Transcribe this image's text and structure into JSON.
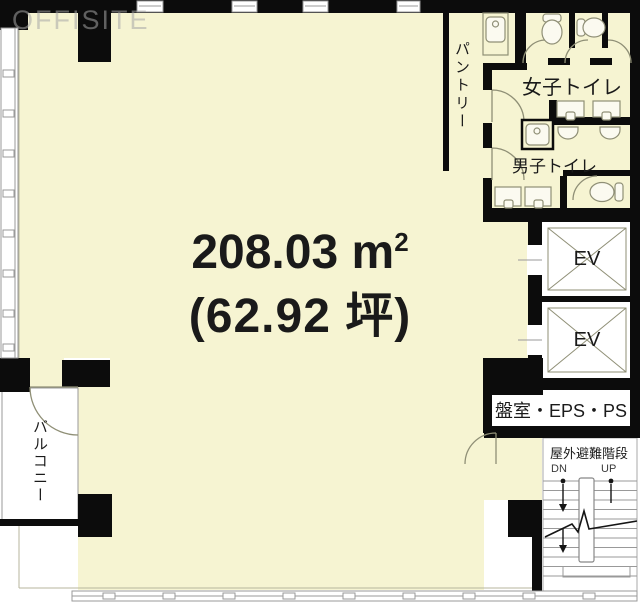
{
  "watermark": "OFFISITE",
  "area": {
    "value": "208.03",
    "unit": "m",
    "sup": "2",
    "tsubo": "(62.92 坪)"
  },
  "labels": {
    "pantry": "パントリー",
    "womens_toilet": "女子トイレ",
    "mens_toilet": "男子トイレ",
    "elevator_1": "EV",
    "elevator_2": "EV",
    "utility_room": "盤室・EPS・PS",
    "outdoor_stairs": "屋外避難階段",
    "down": "DN",
    "up": "UP",
    "balcony": "バルコニー"
  },
  "colors": {
    "floor": "#f6f4d2",
    "wall": "#0c0c0c",
    "fixture_line": "#8f8f76",
    "window_line": "#9a9a9a",
    "text": "#1a1a1a"
  }
}
